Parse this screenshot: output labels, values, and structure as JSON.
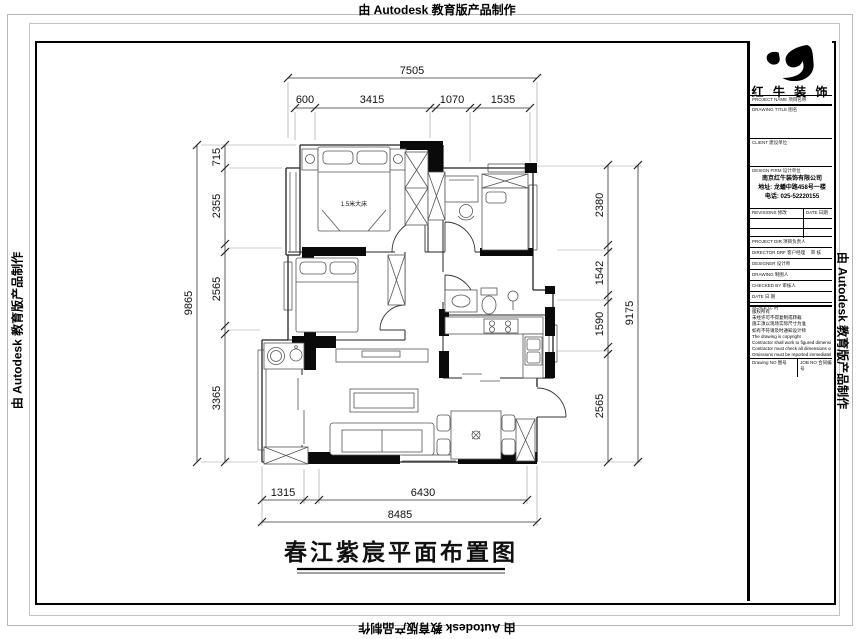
{
  "watermark": "由 Autodesk 教育版产品制作",
  "drawing_title": "春江紫宸平面布置图",
  "plan": {
    "bed_label": "1.5米大床"
  },
  "dimensions": {
    "top": {
      "overall": "7505",
      "segments": [
        "600",
        "3415",
        "1070",
        "1535"
      ]
    },
    "left": {
      "overall": "9865",
      "segments": [
        "715",
        "2355",
        "2565",
        "3365"
      ]
    },
    "right": {
      "overall": "9175",
      "segments": [
        "2380",
        "1542",
        "1590",
        "2565"
      ]
    },
    "bottom": {
      "overall": "8485",
      "segments": [
        "1315",
        "6430"
      ]
    }
  },
  "title_block": {
    "brand": "红 牛 装 饰",
    "project_label": "PROJECT NAME 项目名称",
    "drawing_title_label": "DRAWING TITLE 图名",
    "client_label": "CLIENT 建设单位",
    "design_firm_label": "DESIGN FIRM 设计单位",
    "firm_name": "南京红牛装饰有限公司",
    "firm_address": "地址: 龙蟠中路458号一楼",
    "firm_phone": "电话: 025-52220155",
    "revisions_label": "REVISIONS 修改",
    "date_label": "DATE 日期",
    "rows": [
      {
        "label": "PROJECT DIR 项目负责人",
        "value": ""
      },
      {
        "label": "DIRECTOR DRF 客户经理",
        "value": "审 核"
      },
      {
        "label": "DESIGNER 设计师",
        "value": ""
      },
      {
        "label": "DRAWING 制图人",
        "value": ""
      },
      {
        "label": "CHECKED BY 审核人",
        "value": ""
      },
      {
        "label": "DATE 日 期",
        "value": ""
      },
      {
        "label": "SCALE 比 例",
        "value": ""
      }
    ],
    "notes": [
      "版权所有",
      "未经许可不得复制或转载",
      "施工须以现场实际尺寸为准",
      "如有不符请及时通知设计师",
      "The drawing is copyright",
      "Contractor shall work to figured dimensions only",
      "Contractor must check all dimensions on site",
      "Omissions must be reported immediately to architects"
    ],
    "drawing_no_label": "Drawing NO 图号",
    "job_no_label": "JOB NO 合同编号"
  }
}
